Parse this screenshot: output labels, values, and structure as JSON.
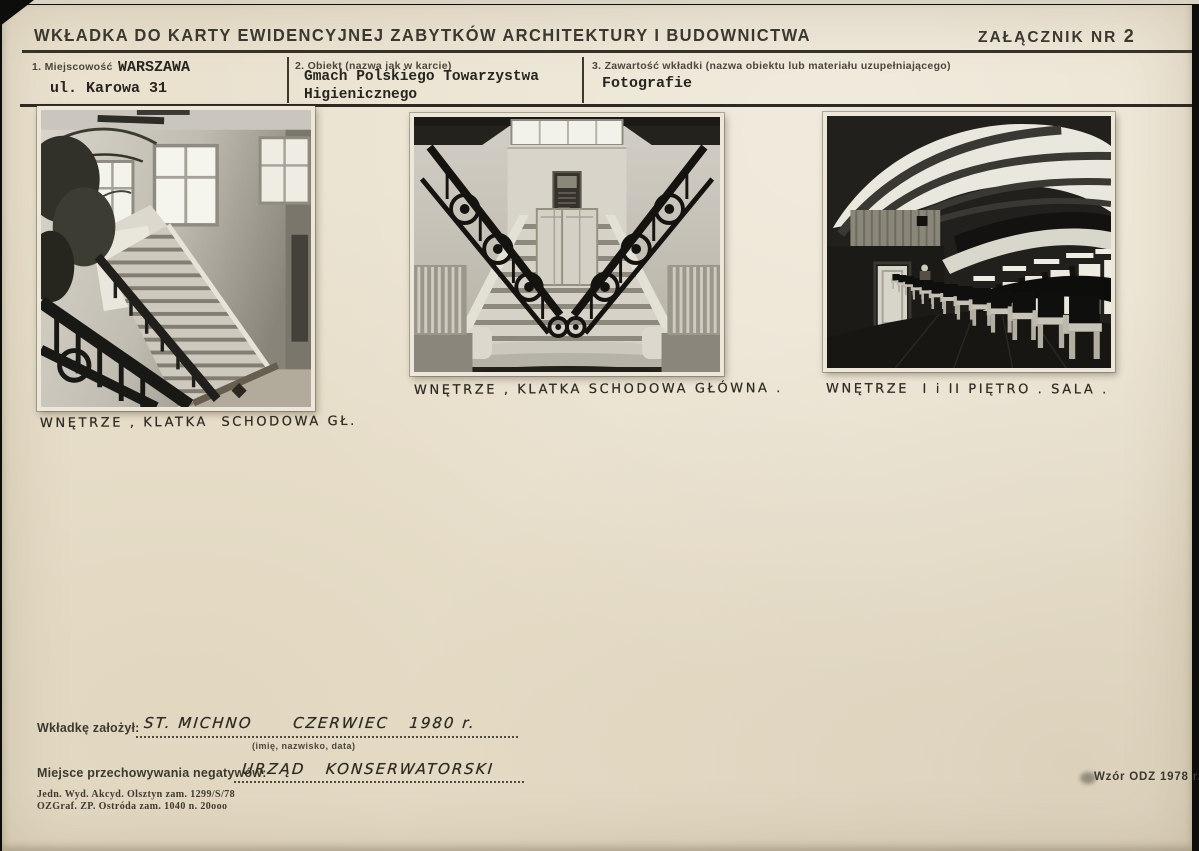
{
  "document": {
    "title": "WKŁADKA DO KARTY EWIDENCYJNEJ ZABYTKÓW ARCHITEKTURY I BUDOWNICTWA",
    "attachment": {
      "label": "ZAŁĄCZNIK NR ",
      "number": "2"
    },
    "fields": [
      {
        "label": "1. Miejscowość",
        "line1": "WARSZAWA",
        "line2": "ul. Karowa 31"
      },
      {
        "label": "2. Obiekt (nazwa jak w karcie)",
        "line1": "Gmach Polskiego Towarzystwa",
        "line2": "Higienicznego"
      },
      {
        "label": "3. Zawartość wkładki (nazwa obiektu lub materiału uzupełniającego)",
        "line1": "Fotografie",
        "line2": ""
      }
    ],
    "photos": [
      {
        "caption": "WNĘTRZE , KLATKA  SCHODOWA GŁ.",
        "depicts": "interior, main staircase, side view with windows and plant"
      },
      {
        "caption": "WNĘTRZE , KLATKA SCHODOWA GŁÓWNA .",
        "depicts": "interior, grand main staircase, frontal symmetric view"
      },
      {
        "caption": "WNĘTRZE  I i II PIĘTRO . SALA .",
        "depicts": "interior, 1st and 2nd floor hall with chairs and skylight ceiling"
      }
    ],
    "footer": {
      "founder_label": "Wkładkę założył:",
      "founder_value": "ST. MICHNO      CZERWIEC   1980 r.",
      "founder_hint": "(imię, nazwisko, data)",
      "negatives_label": "Miejsce przechowywania negatywów:",
      "negatives_value": "URZĄD   KONSERWATORSKI",
      "imprint_line1": "Jedn. Wyd. Akcyd. Olsztyn zam. 1299/S/78",
      "imprint_line2": "OZGraf. ZP. Ostróda zam. 1040 n. 20ooo",
      "form_note": "Wzór ODZ 1978 r."
    },
    "colors": {
      "paper": "#eae2cf",
      "ink": "#33312a",
      "rule": "#35322a",
      "photo_border": "#ece7d8"
    }
  }
}
